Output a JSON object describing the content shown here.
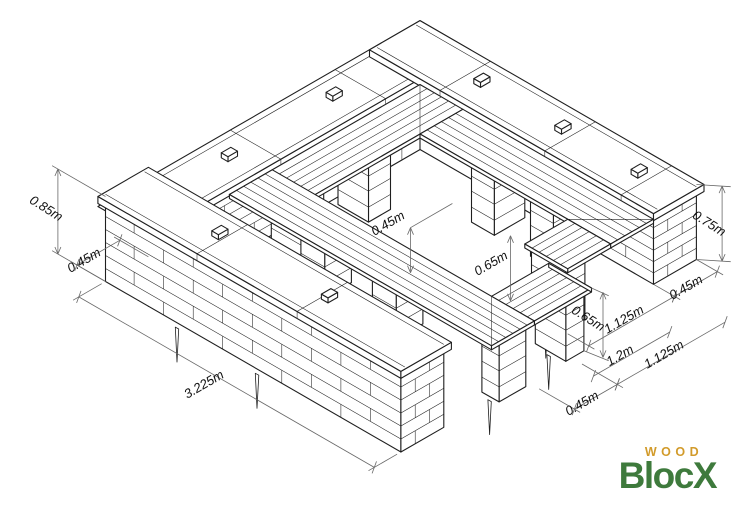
{
  "diagram": {
    "dimensions": [
      {
        "id": "front-wall-height",
        "label": "0.85m"
      },
      {
        "id": "front-wall-thickness",
        "label": "0.45m"
      },
      {
        "id": "front-wall-length",
        "label": "3.225m"
      },
      {
        "id": "bottom-bench-width",
        "label": "0.45m"
      },
      {
        "id": "bottom-bench-length",
        "label": "1.125m"
      },
      {
        "id": "bottom-bench-height",
        "label": "0.65m"
      },
      {
        "id": "opening-gap",
        "label": "1.2m"
      },
      {
        "id": "right-bench-length",
        "label": "1.125m"
      },
      {
        "id": "right-wall-thickness",
        "label": "0.45m"
      },
      {
        "id": "right-wall-height",
        "label": "0.75m"
      },
      {
        "id": "inner-height",
        "label": "0.45m"
      },
      {
        "id": "right-bench-height",
        "label": "0.65m"
      }
    ]
  },
  "logo": {
    "wood": "WOOD",
    "blocx": "BlocX",
    "wood_color": "#D29B2B",
    "blocx_color": "#3E7A3C"
  }
}
